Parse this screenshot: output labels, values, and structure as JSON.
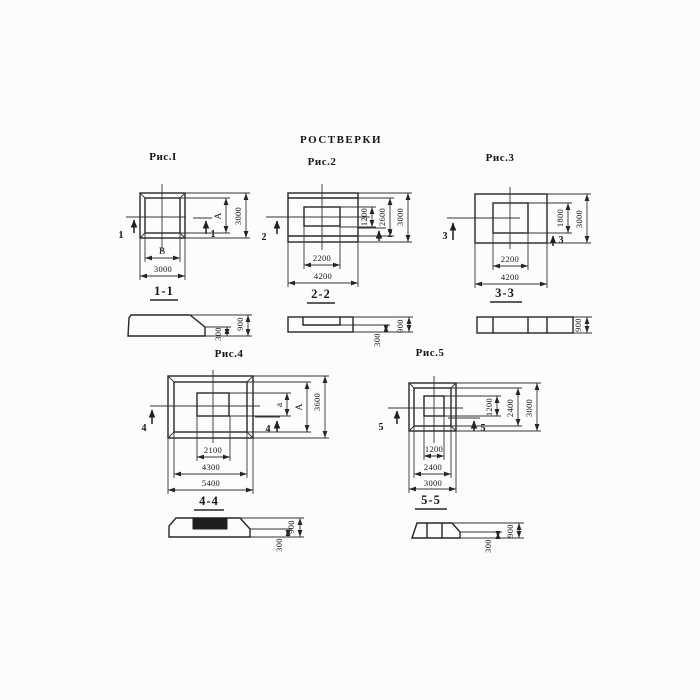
{
  "title": "РОСТВЕРКИ",
  "figures": {
    "fig1": {
      "label": "Рис.I",
      "cut_mark": "1",
      "section_label": "1-1",
      "dim_side_inner": "А",
      "dim_side_outer": "3000",
      "dim_bottom_inner": "В",
      "dim_bottom_outer": "3000"
    },
    "fig2": {
      "label": "Рис.2",
      "cut_mark": "2",
      "section_label": "2-2",
      "dim_side_inner": "1200",
      "dim_side_mid": "2600",
      "dim_side_outer": "3000",
      "dim_bottom_inner": "2200",
      "dim_bottom_outer": "4200"
    },
    "fig3": {
      "label": "Рис.3",
      "cut_mark": "3",
      "section_label": "3-3",
      "dim_side_inner": "1800",
      "dim_side_outer": "3000",
      "dim_bottom_inner": "2200",
      "dim_bottom_outer": "4200"
    },
    "fig4": {
      "label": "Рис.4",
      "cut_mark": "4",
      "section_label": "4-4",
      "dim_side_inner": "а",
      "dim_side_mid": "А",
      "dim_side_outer": "3600",
      "dim_bottom_inner": "2100",
      "dim_bottom_mid": "4300",
      "dim_bottom_outer": "5400"
    },
    "fig5": {
      "label": "Рис.5",
      "cut_mark": "5",
      "section_label": "5-5",
      "dim_side_inner": "1200",
      "dim_side_mid": "2400",
      "dim_side_outer": "3000",
      "dim_bottom_inner": "1200",
      "dim_bottom_mid": "2400",
      "dim_bottom_outer": "3000"
    }
  },
  "sections": {
    "s1": {
      "height_total": "900",
      "height_edge": "300"
    },
    "s2": {
      "height_total": "900",
      "height_edge": "300"
    },
    "s3": {
      "height_total": "900"
    },
    "s4": {
      "height_total": "900",
      "height_edge": "300"
    },
    "s5": {
      "height_total": "900",
      "height_edge": "300"
    }
  }
}
